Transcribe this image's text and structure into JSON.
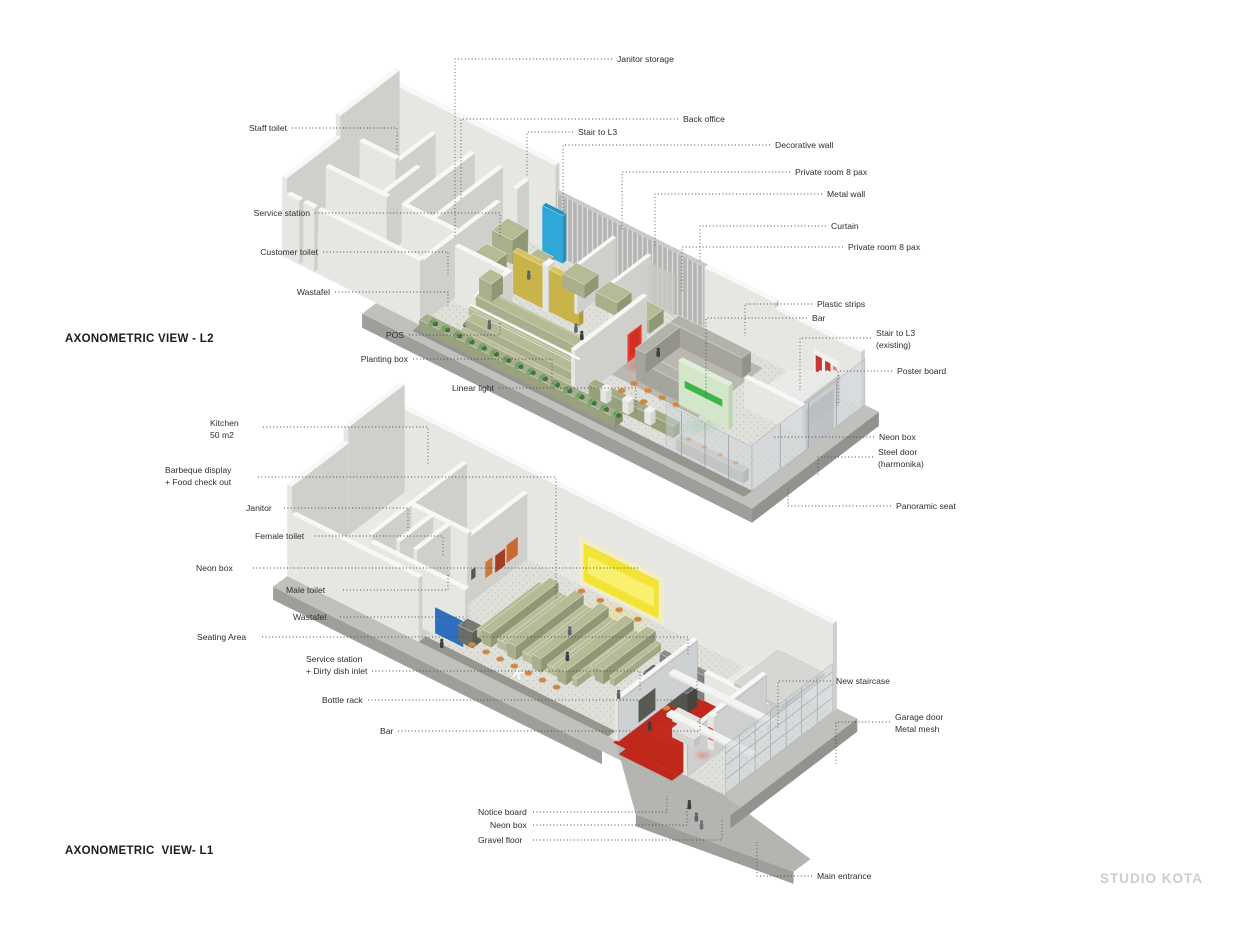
{
  "page": {
    "watermark": "STUDIO KOTA"
  },
  "colors": {
    "wallTop": "#f7f7f5",
    "wallSide": "#e6e6e3",
    "wallShade": "#cfcfcc",
    "floor": "#e9e9e6",
    "gravelBase": "#e0e0db",
    "gravelDot": "#c6c6c0",
    "apron": "#c0c0bd",
    "apronSide": "#9e9e9b",
    "walkDark": "#96968f",
    "olive": "#a9ae8c",
    "oliveTop": "#b6bb96",
    "oliveDark": "#8f9774",
    "benchLight": "#b8bc9a",
    "mustard": "#c9b44a",
    "mustardTop": "#d8c45e",
    "mustardEnd": "#b09c3c",
    "cyan": "#2fa8d8",
    "cyanDark": "#2391bd",
    "blue": "#2e6fc0",
    "blueDark": "#255ba1",
    "red": "#e8392b",
    "redDeep": "#b5271b",
    "redFloor": "#c0281c",
    "neonGreen": "#3eb54a",
    "paleGreen": "#d3e6c9",
    "paleGreenTop": "#e0eed8",
    "paleGreenSide": "#bdd5b1",
    "neonYellow": "#f2e335",
    "yellowCore": "#f8f06e",
    "orange": "#d9924e",
    "orangeDark": "#b87436",
    "plant1": "#5e8a5a",
    "plant2": "#7aa86c",
    "plant3": "#3f6b44",
    "slat": "#b4b4b2",
    "slatLight": "#dcdcda",
    "charcoal": "#55554f",
    "charcoalTop": "#6a6a64",
    "charcoalSide": "#45453f",
    "glass": "#cdd4da",
    "frame": "#9aa0a5",
    "person": "#5f6468",
    "personDark": "#3a3e42",
    "posterRed": "#c23b30",
    "picOrange": "#c96a35",
    "picRust": "#a33d24",
    "leader": "#4a4a4a",
    "labelText": "#2e2e2e",
    "watermark": "#c9cdd2"
  },
  "views": {
    "l2": {
      "title": "AXONOMETRIC VIEW - L2",
      "title_pos": {
        "x": 65,
        "y": 333
      },
      "labels": [
        {
          "text": "Janitor storage",
          "x": 617,
          "y": 59,
          "align": "left",
          "leader": [
            [
              612,
              59
            ],
            [
              455,
              59
            ],
            [
              455,
              238
            ]
          ]
        },
        {
          "text": "Staff toilet",
          "x": 287,
          "y": 128,
          "align": "right",
          "leader": [
            [
              292,
              128
            ],
            [
              397,
              128
            ],
            [
              397,
              150
            ]
          ]
        },
        {
          "text": "Back office",
          "x": 683,
          "y": 119,
          "align": "left",
          "leader": [
            [
              678,
              119
            ],
            [
              461,
              119
            ],
            [
              461,
              200
            ]
          ]
        },
        {
          "text": "Stair to L3",
          "x": 578,
          "y": 132,
          "align": "left",
          "leader": [
            [
              573,
              132
            ],
            [
              527,
              132
            ],
            [
              527,
              176
            ]
          ]
        },
        {
          "text": "Decorative wall",
          "x": 775,
          "y": 145,
          "align": "left",
          "leader": [
            [
              770,
              145
            ],
            [
              563,
              145
            ],
            [
              563,
              213
            ]
          ]
        },
        {
          "text": "Private room 8 pax",
          "x": 795,
          "y": 172,
          "align": "left",
          "leader": [
            [
              790,
              172
            ],
            [
              622,
              172
            ],
            [
              622,
              230
            ]
          ]
        },
        {
          "text": "Metal wall",
          "x": 827,
          "y": 194,
          "align": "left",
          "leader": [
            [
              822,
              194
            ],
            [
              655,
              194
            ],
            [
              655,
              246
            ]
          ]
        },
        {
          "text": "Curtain",
          "x": 831,
          "y": 226,
          "align": "left",
          "leader": [
            [
              826,
              226
            ],
            [
              700,
              226
            ],
            [
              700,
              262
            ]
          ]
        },
        {
          "text": "Private room 8 pax",
          "x": 848,
          "y": 247,
          "align": "left",
          "leader": [
            [
              843,
              247
            ],
            [
              682,
              247
            ],
            [
              682,
              292
            ]
          ]
        },
        {
          "text": "Service station",
          "x": 310,
          "y": 213,
          "align": "right",
          "leader": [
            [
              315,
              213
            ],
            [
              500,
              213
            ],
            [
              500,
              238
            ]
          ]
        },
        {
          "text": "Customer toilet",
          "x": 318,
          "y": 252,
          "align": "right",
          "leader": [
            [
              323,
              252
            ],
            [
              448,
              252
            ],
            [
              448,
              276
            ]
          ]
        },
        {
          "text": "Wastafel",
          "x": 330,
          "y": 292,
          "align": "right",
          "leader": [
            [
              335,
              292
            ],
            [
              448,
              292
            ],
            [
              448,
              306
            ]
          ]
        },
        {
          "text": "Plastic strips",
          "x": 817,
          "y": 304,
          "align": "left",
          "leader": [
            [
              812,
              304
            ],
            [
              745,
              304
            ],
            [
              745,
              336
            ]
          ]
        },
        {
          "text": "Bar",
          "x": 812,
          "y": 318,
          "align": "left",
          "leader": [
            [
              807,
              318
            ],
            [
              706,
              318
            ],
            [
              706,
              398
            ]
          ]
        },
        {
          "text": "POS",
          "x": 404,
          "y": 335,
          "align": "right",
          "leader": [
            [
              409,
              335
            ],
            [
              500,
              335
            ],
            [
              500,
              321
            ]
          ]
        },
        {
          "text": "Stair to L3\n(existing)",
          "x": 876,
          "y": 333,
          "align": "left",
          "leader": [
            [
              871,
              338
            ],
            [
              800,
              338
            ],
            [
              800,
              390
            ]
          ]
        },
        {
          "text": "Planting box",
          "x": 408,
          "y": 359,
          "align": "right",
          "leader": [
            [
              413,
              359
            ],
            [
              552,
              359
            ],
            [
              552,
              384
            ]
          ]
        },
        {
          "text": "Poster board",
          "x": 897,
          "y": 371,
          "align": "left",
          "leader": [
            [
              892,
              371
            ],
            [
              838,
              371
            ],
            [
              838,
              406
            ]
          ]
        },
        {
          "text": "Linear light",
          "x": 494,
          "y": 388,
          "align": "right",
          "leader": [
            [
              499,
              388
            ],
            [
              636,
              388
            ],
            [
              636,
              412
            ]
          ]
        },
        {
          "text": "Neon box",
          "x": 879,
          "y": 437,
          "align": "left",
          "leader": [
            [
              874,
              437
            ],
            [
              772,
              437
            ]
          ]
        },
        {
          "text": "Steel door\n(harmonika)",
          "x": 878,
          "y": 452,
          "align": "left",
          "leader": [
            [
              873,
              457
            ],
            [
              818,
              457
            ],
            [
              818,
              477
            ]
          ]
        },
        {
          "text": "Panoramic seat",
          "x": 896,
          "y": 506,
          "align": "left",
          "leader": [
            [
              891,
              506
            ],
            [
              788,
              506
            ],
            [
              788,
              489
            ]
          ]
        }
      ]
    },
    "l1": {
      "title": "AXONOMETRIC  VIEW- L1",
      "title_pos": {
        "x": 65,
        "y": 845
      },
      "labels": [
        {
          "text": "Kitchen\n50 m2",
          "x": 210,
          "y": 423,
          "align": "left",
          "leader": [
            [
              263,
              427
            ],
            [
              428,
              427
            ],
            [
              428,
              466
            ]
          ]
        },
        {
          "text": "Barbeque display\n+ Food check out",
          "x": 165,
          "y": 470,
          "align": "left",
          "leader": [
            [
              258,
              477
            ],
            [
              556,
              477
            ],
            [
              556,
              598
            ]
          ]
        },
        {
          "text": "Janitor",
          "x": 246,
          "y": 508,
          "align": "left",
          "leader": [
            [
              284,
              508
            ],
            [
              408,
              508
            ],
            [
              408,
              531
            ]
          ]
        },
        {
          "text": "Female toilet",
          "x": 255,
          "y": 536,
          "align": "left",
          "leader": [
            [
              315,
              536
            ],
            [
              443,
              536
            ],
            [
              443,
              557
            ]
          ]
        },
        {
          "text": "Neon box",
          "x": 196,
          "y": 568,
          "align": "left",
          "leader": [
            [
              253,
              568
            ],
            [
              638,
              568
            ]
          ]
        },
        {
          "text": "Male toilet",
          "x": 286,
          "y": 590,
          "align": "left",
          "leader": [
            [
              343,
              590
            ],
            [
              448,
              590
            ],
            [
              448,
              573
            ]
          ]
        },
        {
          "text": "Wastafel",
          "x": 293,
          "y": 617,
          "align": "left",
          "leader": [
            [
              340,
              617
            ],
            [
              464,
              617
            ],
            [
              464,
              634
            ]
          ]
        },
        {
          "text": "Seating Area",
          "x": 197,
          "y": 637,
          "align": "left",
          "leader": [
            [
              262,
              637
            ],
            [
              688,
              637
            ],
            [
              688,
              654
            ]
          ]
        },
        {
          "text": "Service station\n+ Dirty dish inlet",
          "x": 306,
          "y": 659,
          "align": "left",
          "leader": [
            [
              372,
              671
            ],
            [
              640,
              671
            ],
            [
              640,
              690
            ]
          ]
        },
        {
          "text": "Bottle rack",
          "x": 322,
          "y": 700,
          "align": "left",
          "leader": [
            [
              368,
              700
            ],
            [
              697,
              700
            ],
            [
              697,
              681
            ]
          ]
        },
        {
          "text": "Bar",
          "x": 380,
          "y": 731,
          "align": "left",
          "leader": [
            [
              398,
              731
            ],
            [
              700,
              731
            ],
            [
              700,
              716
            ]
          ]
        },
        {
          "text": "New staircase",
          "x": 836,
          "y": 681,
          "align": "left",
          "leader": [
            [
              831,
              681
            ],
            [
              778,
              681
            ],
            [
              778,
              730
            ]
          ]
        },
        {
          "text": "Garage door\nMetal mesh",
          "x": 895,
          "y": 717,
          "align": "left",
          "leader": [
            [
              890,
              722
            ],
            [
              836,
              722
            ],
            [
              836,
              764
            ]
          ]
        },
        {
          "text": "Notice board",
          "x": 478,
          "y": 812,
          "align": "left",
          "leader": [
            [
              533,
              812
            ],
            [
              667,
              812
            ],
            [
              667,
              796
            ]
          ]
        },
        {
          "text": "Neon box",
          "x": 490,
          "y": 825,
          "align": "left",
          "leader": [
            [
              533,
              825
            ],
            [
              687,
              825
            ],
            [
              687,
              808
            ]
          ]
        },
        {
          "text": "Gravel floor",
          "x": 478,
          "y": 840,
          "align": "left",
          "leader": [
            [
              533,
              840
            ],
            [
              722,
              840
            ],
            [
              722,
              818
            ]
          ]
        },
        {
          "text": "Main entrance",
          "x": 817,
          "y": 876,
          "align": "left",
          "leader": [
            [
              812,
              876
            ],
            [
              757,
              876
            ],
            [
              757,
              842
            ]
          ]
        }
      ]
    }
  }
}
